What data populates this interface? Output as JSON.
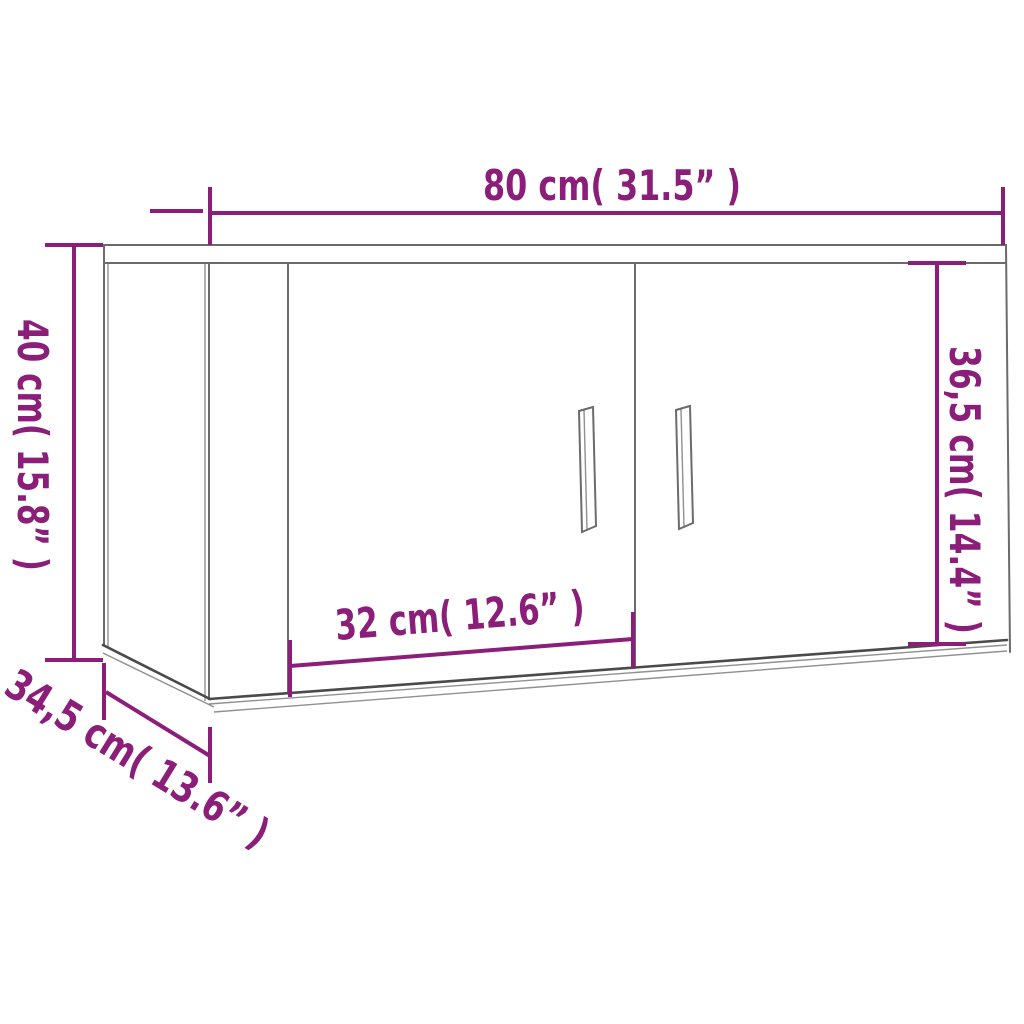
{
  "figure": {
    "type": "furniture-dimension-diagram",
    "subject": "wall-mounted two-door cabinet shown in perspective with magenta dimension lines"
  },
  "dimensions": [
    {
      "id": "overall-width",
      "cm": "80",
      "inch": "31.5",
      "label": "80 cm( 31.5” )"
    },
    {
      "id": "overall-height",
      "cm": "40",
      "inch": "15.8",
      "label": "40 cm( 15.8” )"
    },
    {
      "id": "front-height",
      "cm": "36,5",
      "inch": "14.4",
      "label": "36,5 cm( 14.4” )"
    },
    {
      "id": "door-width",
      "cm": "32",
      "inch": "12.6",
      "label": "32 cm( 12.6” )"
    },
    {
      "id": "depth",
      "cm": "34,5",
      "inch": "13.6",
      "label": "34,5 cm( 13.6” )"
    }
  ],
  "colors": {
    "dimension_accent": "#8b1e79",
    "cabinet_line": "#6b6b6b",
    "cabinet_line_dark": "#4a4a4a",
    "background": "#ffffff"
  }
}
